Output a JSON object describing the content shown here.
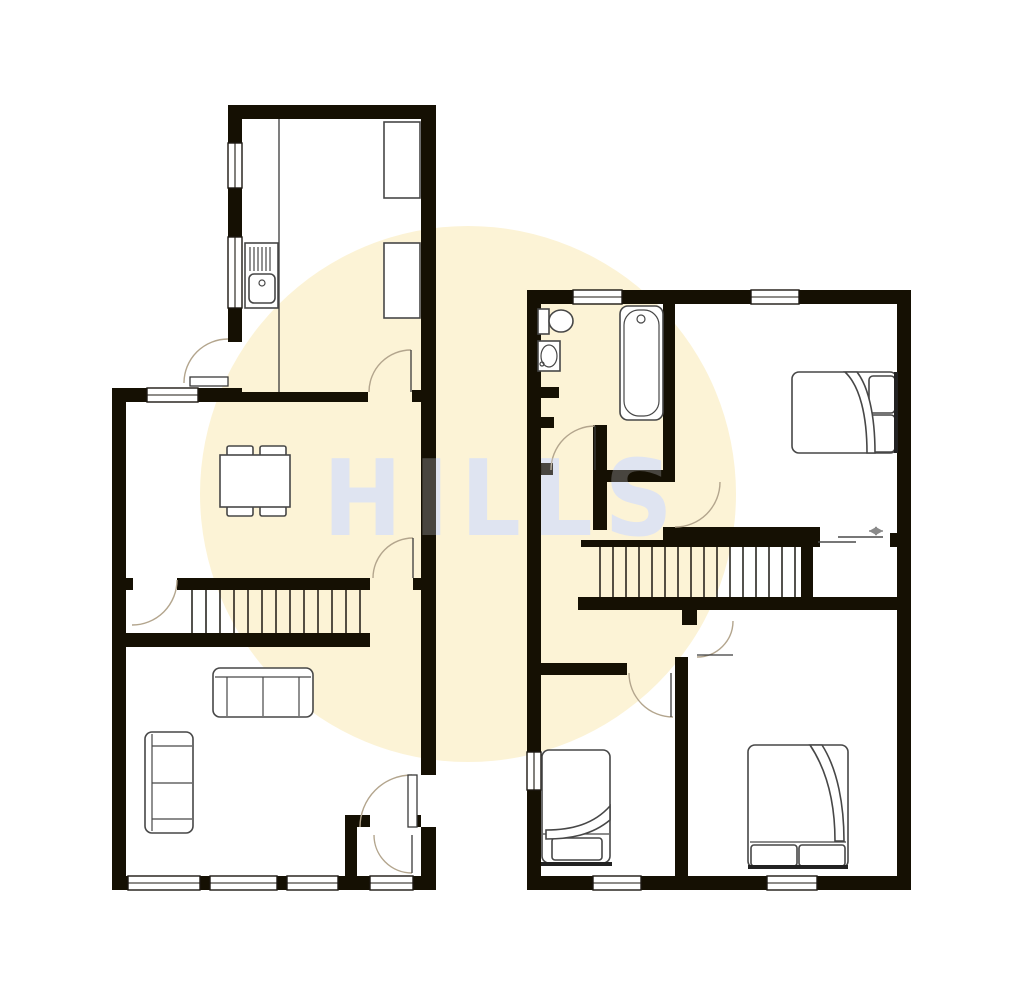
{
  "watermark": {
    "text": "HILLS"
  },
  "colors": {
    "background": "#ffffff",
    "wall": "#151003",
    "watermark_circle": "#fcf3d6",
    "watermark_text": "#dfe4f1",
    "door_arc": "#b3a58d",
    "furniture_outline": "#474747"
  },
  "plan": {
    "type": "floorplan",
    "floors": [
      {
        "name": "ground-floor",
        "position": "left",
        "rooms": [
          {
            "name": "kitchen",
            "fixtures": [
              "sink-with-drainer",
              "worktop",
              "kitchen-unit",
              "kitchen-unit",
              "back-door",
              "window",
              "window"
            ]
          },
          {
            "name": "dining-room",
            "fixtures": [
              "dining-table",
              "chair",
              "chair",
              "chair",
              "chair",
              "window"
            ]
          },
          {
            "name": "staircase",
            "fixtures": [
              "stairs-13-treads",
              "door",
              "door"
            ]
          },
          {
            "name": "living-room",
            "fixtures": [
              "sofa-two-seat",
              "sofa-two-seat",
              "window",
              "window",
              "window"
            ]
          },
          {
            "name": "entrance-porch",
            "fixtures": [
              "front-door",
              "inner-door",
              "window"
            ]
          }
        ]
      },
      {
        "name": "first-floor",
        "position": "right",
        "rooms": [
          {
            "name": "bathroom",
            "fixtures": [
              "toilet",
              "basin",
              "bath",
              "window",
              "chimney-recess"
            ]
          },
          {
            "name": "landing",
            "fixtures": [
              "stairs-16-treads",
              "sliding-door-indicator"
            ]
          },
          {
            "name": "bedroom-1",
            "fixtures": [
              "double-bed",
              "window",
              "sliding-door"
            ]
          },
          {
            "name": "bedroom-2",
            "fixtures": [
              "double-bed",
              "window",
              "door"
            ]
          },
          {
            "name": "bedroom-3",
            "fixtures": [
              "single-bed",
              "window",
              "window",
              "door"
            ]
          }
        ]
      }
    ]
  }
}
